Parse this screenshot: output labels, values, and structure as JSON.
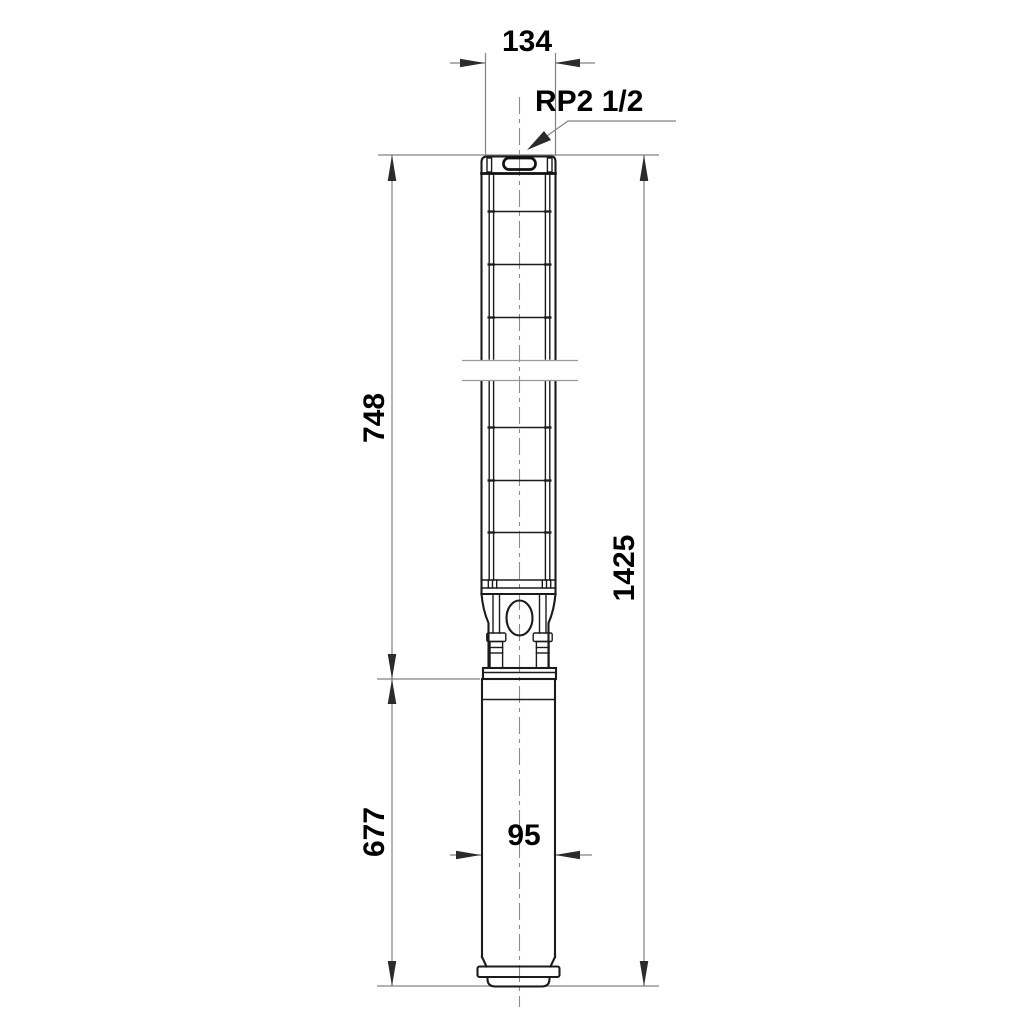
{
  "drawing": {
    "dimensions": {
      "width_top": "134",
      "connection": "RP2 1/2",
      "length_upper": "748",
      "length_total": "1425",
      "length_lower": "677",
      "width_bottom": "95"
    },
    "colors": {
      "outline": "#1b1b1b",
      "dimension_lines": "#828282",
      "centerline": "#8a8a8a",
      "text": "#000000",
      "background": "#ffffff"
    }
  }
}
